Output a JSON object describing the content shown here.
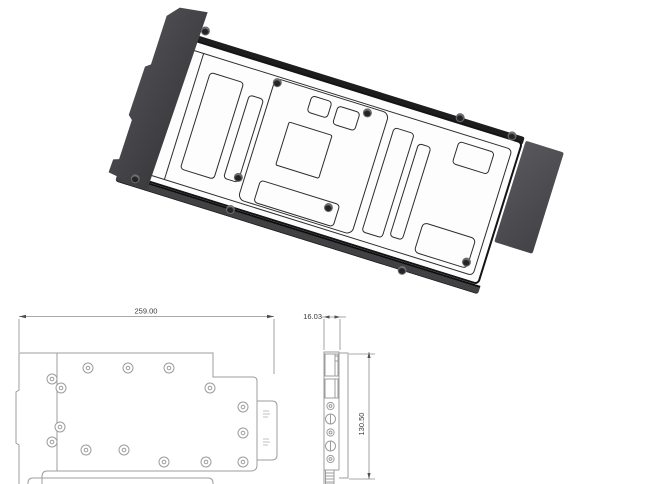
{
  "top_view": {
    "width_dim": "259.00"
  },
  "side_view": {
    "thickness_dim": "16.03",
    "height_dim": "130.50"
  },
  "colors": {
    "outline": "#141415",
    "end_cap": "#454549",
    "io_plate": "#4b4b4f",
    "bottom_rim": "#414144",
    "plate_fill": "#fdfdfd",
    "drawing_line": "#9c9c9c",
    "dimension_text": "#3a3a3a",
    "screw": "#242426"
  }
}
